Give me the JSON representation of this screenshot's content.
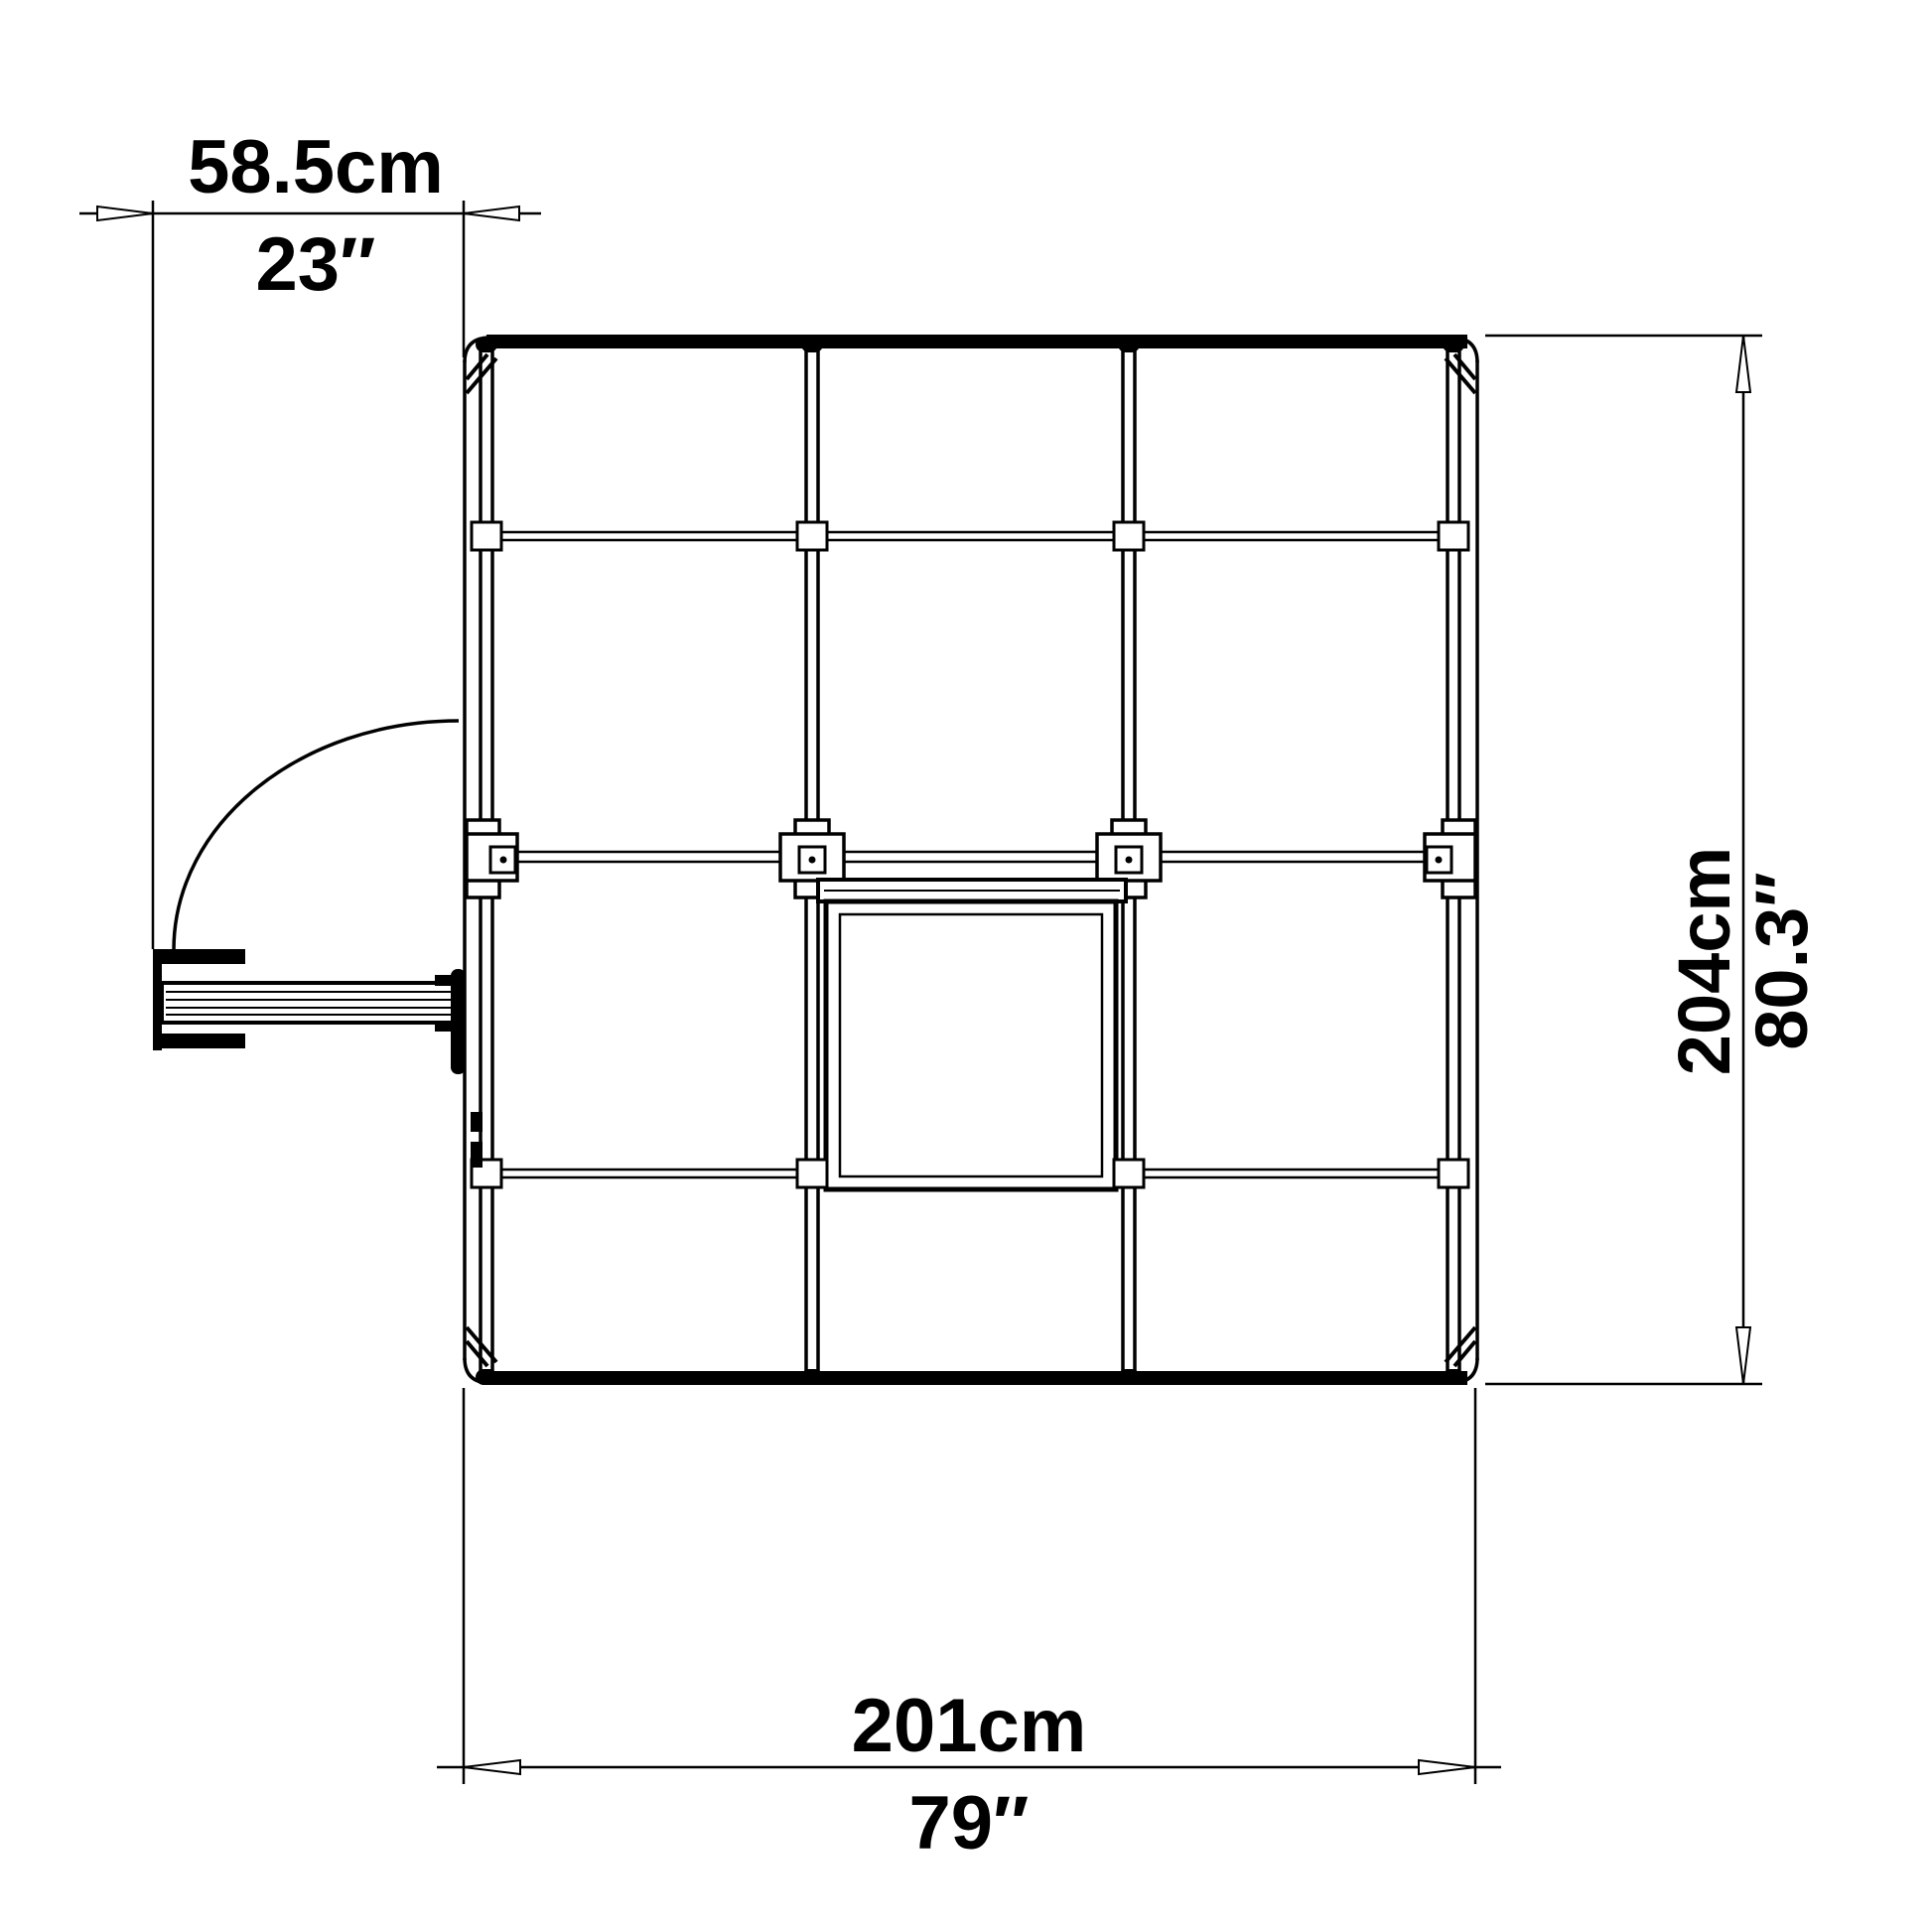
{
  "colors": {
    "line": "#000000",
    "background": "#ffffff"
  },
  "dimensions": {
    "door_width": {
      "metric": "58.5cm",
      "imperial": "23″"
    },
    "overall_width": {
      "metric": "201cm",
      "imperial": "79″"
    },
    "overall_depth": {
      "metric": "204cm",
      "imperial": "80.3″"
    }
  }
}
